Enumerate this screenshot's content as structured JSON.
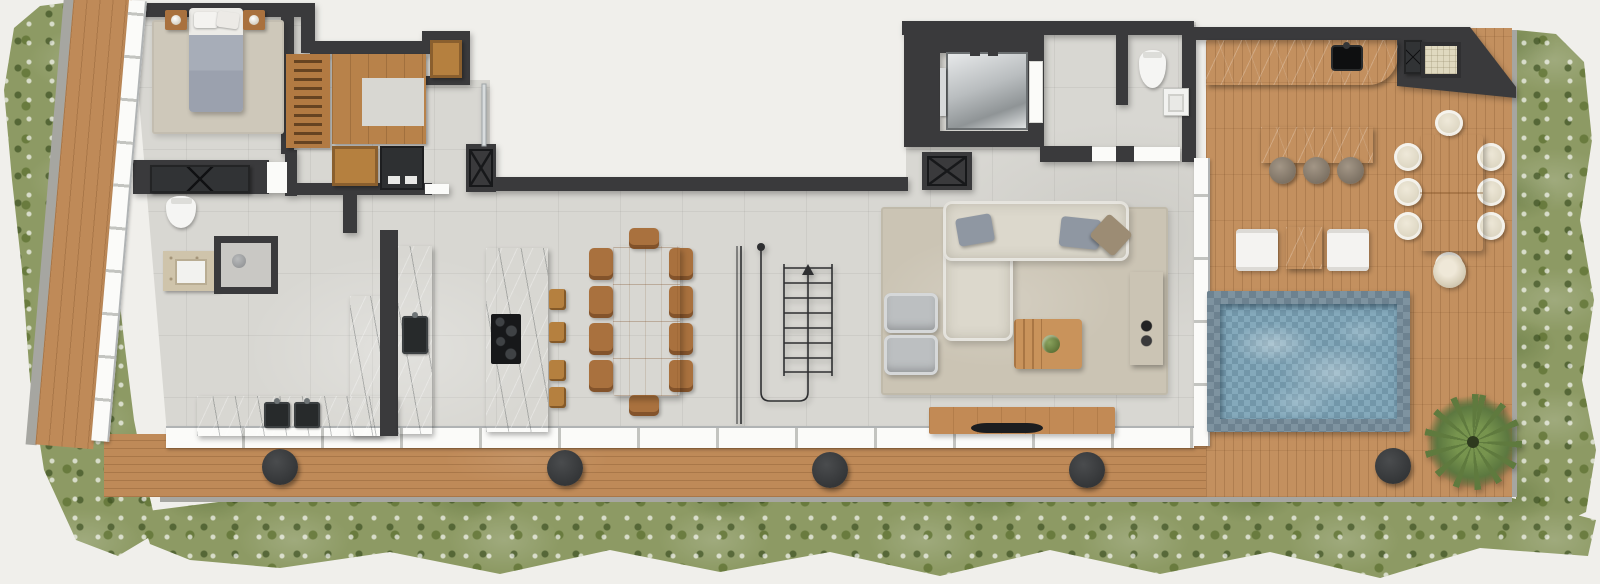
{
  "scene": {
    "kind": "residential-floor-plan-render",
    "orientation": "top-down",
    "text_labels": []
  },
  "palette": {
    "bg": "#f0efeb",
    "wall": "#3a3a3c",
    "tile": "#d8d7d2",
    "deck": "#bf8a58",
    "terrace": "#c3905f",
    "stone": "#9aa0a2",
    "darkstone": "#484e51",
    "water": "#7fa6b8",
    "green": "#8d9a64",
    "rug": "#cec8ba"
  },
  "rooms": [
    {
      "name": "bedroom"
    },
    {
      "name": "walk-in-closet"
    },
    {
      "name": "bathroom"
    },
    {
      "name": "kitchen"
    },
    {
      "name": "dining-area"
    },
    {
      "name": "stair-hall"
    },
    {
      "name": "living-room"
    },
    {
      "name": "elevator-lobby"
    },
    {
      "name": "powder-room"
    },
    {
      "name": "roof-terrace"
    },
    {
      "name": "pool-deck"
    }
  ],
  "elements": [
    {
      "type": "rug",
      "name": "bedroom-rug",
      "x": 152,
      "y": 20,
      "w": 132,
      "h": 114
    },
    {
      "type": "bed",
      "name": "bed",
      "x": 189,
      "y": 8,
      "w": 54,
      "h": 104
    },
    {
      "type": "nightstand",
      "name": "nightstand-left",
      "x": 165,
      "y": 10,
      "w": 22,
      "h": 20
    },
    {
      "type": "nightstand",
      "name": "nightstand-right",
      "x": 243,
      "y": 10,
      "w": 22,
      "h": 20
    },
    {
      "type": "xcab",
      "name": "bedroom-dresser",
      "x": 150,
      "y": 165,
      "w": 100,
      "h": 28
    },
    {
      "type": "wardrobe",
      "name": "wardrobe-rack",
      "x": 286,
      "y": 54,
      "w": 44,
      "h": 94
    },
    {
      "type": "closetu",
      "name": "closet-u-unit",
      "x": 332,
      "y": 54,
      "w": 94,
      "h": 90
    },
    {
      "type": "woodbox",
      "name": "closet-top-cabinet",
      "x": 430,
      "y": 40,
      "w": 32,
      "h": 38
    },
    {
      "type": "woodbox",
      "name": "closet-bench",
      "x": 332,
      "y": 146,
      "w": 46,
      "h": 40
    },
    {
      "type": "washer",
      "name": "laundry-unit",
      "x": 380,
      "y": 146,
      "w": 44,
      "h": 44
    },
    {
      "type": "toilet",
      "name": "bathroom-toilet",
      "x": 166,
      "y": 196,
      "w": 30,
      "h": 32
    },
    {
      "type": "vanity",
      "name": "bathroom-vanity",
      "x": 163,
      "y": 251,
      "w": 56,
      "h": 40
    },
    {
      "type": "shower",
      "name": "shower",
      "x": 214,
      "y": 236,
      "w": 64,
      "h": 58
    },
    {
      "type": "stone",
      "name": "kitchen-counter-bottom",
      "x": 197,
      "y": 396,
      "w": 200,
      "h": 40
    },
    {
      "type": "darksink",
      "name": "kitchen-sink-left",
      "x": 264,
      "y": 402,
      "w": 26,
      "h": 26
    },
    {
      "type": "darksink",
      "name": "kitchen-sink-right",
      "x": 294,
      "y": 402,
      "w": 26,
      "h": 26
    },
    {
      "type": "stone",
      "name": "kitchen-counter-side",
      "x": 350,
      "y": 296,
      "w": 32,
      "h": 140
    },
    {
      "type": "darkcol",
      "name": "kitchen-tall-cabinet",
      "x": 380,
      "y": 230,
      "w": 18,
      "h": 206
    },
    {
      "type": "stone",
      "name": "kitchen-counter-tall",
      "x": 398,
      "y": 246,
      "w": 34,
      "h": 188
    },
    {
      "type": "darksink",
      "name": "kitchen-prep-sink",
      "x": 402,
      "y": 316,
      "w": 26,
      "h": 38
    },
    {
      "type": "stone",
      "name": "kitchen-island",
      "x": 486,
      "y": 248,
      "w": 62,
      "h": 184
    },
    {
      "type": "cooktop",
      "name": "cooktop",
      "x": 491,
      "y": 314,
      "w": 30,
      "h": 50
    },
    {
      "type": "stoolw",
      "name": "bar-stool-1",
      "x": 549,
      "y": 289,
      "w": 17,
      "h": 21
    },
    {
      "type": "stoolw",
      "name": "bar-stool-2",
      "x": 549,
      "y": 322,
      "w": 17,
      "h": 21
    },
    {
      "type": "stoolw",
      "name": "bar-stool-3",
      "x": 549,
      "y": 360,
      "w": 17,
      "h": 21
    },
    {
      "type": "stoolw",
      "name": "bar-stool-4",
      "x": 549,
      "y": 387,
      "w": 17,
      "h": 21
    },
    {
      "type": "chairw",
      "name": "dining-chair-1",
      "x": 589,
      "y": 248,
      "w": 24,
      "h": 32
    },
    {
      "type": "chairw",
      "name": "dining-chair-2",
      "x": 589,
      "y": 286,
      "w": 24,
      "h": 32
    },
    {
      "type": "chairw",
      "name": "dining-chair-3",
      "x": 589,
      "y": 323,
      "w": 24,
      "h": 32
    },
    {
      "type": "chairw",
      "name": "dining-chair-4",
      "x": 589,
      "y": 360,
      "w": 24,
      "h": 32
    },
    {
      "type": "chairw",
      "name": "dining-chair-5",
      "x": 669,
      "y": 248,
      "w": 24,
      "h": 32
    },
    {
      "type": "chairw",
      "name": "dining-chair-6",
      "x": 669,
      "y": 286,
      "w": 24,
      "h": 32
    },
    {
      "type": "chairw",
      "name": "dining-chair-7",
      "x": 669,
      "y": 323,
      "w": 24,
      "h": 32
    },
    {
      "type": "chairw",
      "name": "dining-chair-8",
      "x": 669,
      "y": 360,
      "w": 24,
      "h": 32
    },
    {
      "type": "chairw",
      "name": "dining-chair-head-top",
      "x": 629,
      "y": 228,
      "w": 30,
      "h": 21
    },
    {
      "type": "chairw",
      "name": "dining-chair-head-bottom",
      "x": 629,
      "y": 395,
      "w": 30,
      "h": 21
    },
    {
      "type": "woodtable",
      "name": "dining-table",
      "x": 613,
      "y": 246,
      "w": 67,
      "h": 150
    },
    {
      "type": "rug2",
      "name": "living-rug",
      "x": 881,
      "y": 207,
      "w": 287,
      "h": 188
    },
    {
      "type": "sofa",
      "name": "sofa-chaise",
      "x": 943,
      "y": 205,
      "w": 70,
      "h": 136
    },
    {
      "type": "sofa",
      "name": "sofa-main",
      "x": 943,
      "y": 201,
      "w": 186,
      "h": 60
    },
    {
      "type": "pillowg",
      "name": "sofa-pillow-gray-1",
      "x": 957,
      "y": 216,
      "w": 36,
      "h": 28,
      "rot": -10
    },
    {
      "type": "pillowg",
      "name": "sofa-pillow-gray-2",
      "x": 1060,
      "y": 218,
      "w": 40,
      "h": 30,
      "rot": 6
    },
    {
      "type": "pillowt",
      "name": "sofa-pillow-tan",
      "x": 1095,
      "y": 220,
      "w": 32,
      "h": 30,
      "rot": 42
    },
    {
      "type": "armchair",
      "name": "armchair-1",
      "x": 884,
      "y": 293,
      "w": 54,
      "h": 40
    },
    {
      "type": "armchair",
      "name": "armchair-2",
      "x": 884,
      "y": 335,
      "w": 54,
      "h": 40
    },
    {
      "type": "coffeetable",
      "name": "coffee-table",
      "x": 1014,
      "y": 319,
      "w": 68,
      "h": 50
    },
    {
      "type": "darkwood",
      "name": "media-console",
      "x": 1130,
      "y": 272,
      "w": 33,
      "h": 93
    },
    {
      "type": "woodbench",
      "name": "tv-bench",
      "x": 929,
      "y": 407,
      "w": 186,
      "h": 27
    },
    {
      "type": "tv",
      "name": "tv",
      "x": 971,
      "y": 423,
      "w": 72,
      "h": 10
    },
    {
      "type": "elevcab",
      "name": "elevator-cab",
      "x": 946,
      "y": 52,
      "w": 82,
      "h": 78
    },
    {
      "type": "doorgap",
      "name": "elevator-door",
      "x": 1030,
      "y": 62,
      "w": 12,
      "h": 60
    },
    {
      "type": "toilet",
      "name": "powder-toilet",
      "x": 1139,
      "y": 50,
      "w": 27,
      "h": 38
    },
    {
      "type": "sinkunit",
      "name": "powder-sink",
      "x": 1163,
      "y": 88,
      "w": 26,
      "h": 28
    },
    {
      "type": "darkstone notch-br",
      "name": "outdoor-kitchen-counter",
      "x": 1206,
      "y": 40,
      "w": 192,
      "h": 45
    },
    {
      "type": "blacksink",
      "name": "outdoor-sink",
      "x": 1331,
      "y": 45,
      "w": 32,
      "h": 26
    },
    {
      "type": "xcab",
      "name": "terrace-duct",
      "x": 1404,
      "y": 40,
      "w": 18,
      "h": 34
    },
    {
      "type": "planterbox",
      "name": "terrace-planter-box",
      "x": 1421,
      "y": 42,
      "w": 40,
      "h": 36
    },
    {
      "type": "darkstone",
      "name": "terrace-bar-island",
      "x": 1261,
      "y": 127,
      "w": 112,
      "h": 36
    },
    {
      "type": "stoolr",
      "name": "bar-round-stool-1",
      "x": 1269,
      "y": 157,
      "w": 27,
      "h": 27
    },
    {
      "type": "stoolr",
      "name": "bar-round-stool-2",
      "x": 1303,
      "y": 157,
      "w": 27,
      "h": 27
    },
    {
      "type": "stoolr",
      "name": "bar-round-stool-3",
      "x": 1337,
      "y": 157,
      "w": 27,
      "h": 27
    },
    {
      "type": "chairc",
      "name": "terrace-chair-1",
      "x": 1394,
      "y": 143,
      "w": 28,
      "h": 28
    },
    {
      "type": "chairc",
      "name": "terrace-chair-2",
      "x": 1394,
      "y": 178,
      "w": 28,
      "h": 28
    },
    {
      "type": "chairc",
      "name": "terrace-chair-3",
      "x": 1394,
      "y": 212,
      "w": 28,
      "h": 28
    },
    {
      "type": "chairc",
      "name": "terrace-chair-4",
      "x": 1477,
      "y": 143,
      "w": 28,
      "h": 28
    },
    {
      "type": "chairc",
      "name": "terrace-chair-5",
      "x": 1477,
      "y": 178,
      "w": 28,
      "h": 28
    },
    {
      "type": "chairc",
      "name": "terrace-chair-6",
      "x": 1477,
      "y": 212,
      "w": 28,
      "h": 28
    },
    {
      "type": "chairc",
      "name": "terrace-chair-head-top",
      "x": 1435,
      "y": 110,
      "w": 28,
      "h": 26
    },
    {
      "type": "chairc",
      "name": "terrace-chair-head-bottom",
      "x": 1435,
      "y": 252,
      "w": 28,
      "h": 26
    },
    {
      "type": "otable",
      "name": "terrace-dining-table",
      "x": 1420,
      "y": 135,
      "w": 63,
      "h": 116
    },
    {
      "type": "lounger",
      "name": "lounge-chair-1",
      "x": 1236,
      "y": 229,
      "w": 42,
      "h": 42
    },
    {
      "type": "darkstone",
      "name": "lounge-side-table",
      "x": 1286,
      "y": 227,
      "w": 36,
      "h": 42
    },
    {
      "type": "lounger",
      "name": "lounge-chair-2",
      "x": 1327,
      "y": 229,
      "w": 42,
      "h": 42
    },
    {
      "type": "pool",
      "name": "pool",
      "x": 1207,
      "y": 291,
      "w": 203,
      "h": 141
    },
    {
      "type": "platter",
      "name": "round-planter",
      "x": 1433,
      "y": 255,
      "w": 33,
      "h": 33
    },
    {
      "type": "plant",
      "name": "terrace-plant",
      "x": 1424,
      "y": 394,
      "w": 98,
      "h": 96
    },
    {
      "type": "spot",
      "name": "deck-light-1",
      "x": 262,
      "y": 449,
      "w": 36,
      "h": 36
    },
    {
      "type": "spot",
      "name": "deck-light-2",
      "x": 547,
      "y": 450,
      "w": 36,
      "h": 36
    },
    {
      "type": "spot",
      "name": "deck-light-3",
      "x": 812,
      "y": 452,
      "w": 36,
      "h": 36
    },
    {
      "type": "spot",
      "name": "deck-light-4",
      "x": 1069,
      "y": 452,
      "w": 36,
      "h": 36
    },
    {
      "type": "spot",
      "name": "deck-light-5",
      "x": 1375,
      "y": 448,
      "w": 36,
      "h": 36
    }
  ]
}
